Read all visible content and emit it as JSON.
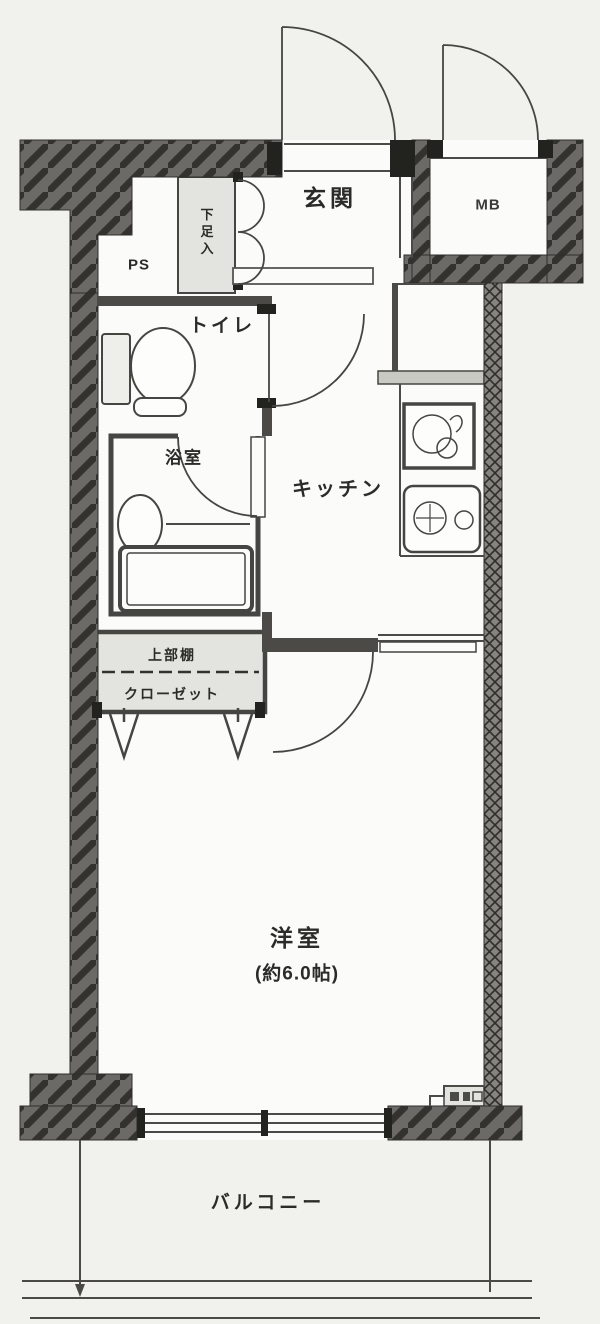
{
  "plan": {
    "type": "apartment-floor-plan",
    "labels": {
      "genkan": "玄関",
      "meter_box": "MB",
      "pipe_space": "PS",
      "shoe_cabinet": "下足入",
      "toilet": "トイレ",
      "bathroom": "浴室",
      "kitchen": "キッチン",
      "upper_shelf": "上部棚",
      "closet": "クローゼット",
      "western_room": "洋室",
      "western_room_size": "(約6.0帖)",
      "balcony": "バルコニー"
    },
    "colors": {
      "background": "#f1f1ee",
      "floor": "#fbfbf9",
      "wall_fill": "#6b6a66",
      "wall_hatch": "#33322f",
      "shared_wall": "#85847f",
      "line": "#454542",
      "shade": "#e3e3df",
      "text": "#2b2b28"
    }
  }
}
